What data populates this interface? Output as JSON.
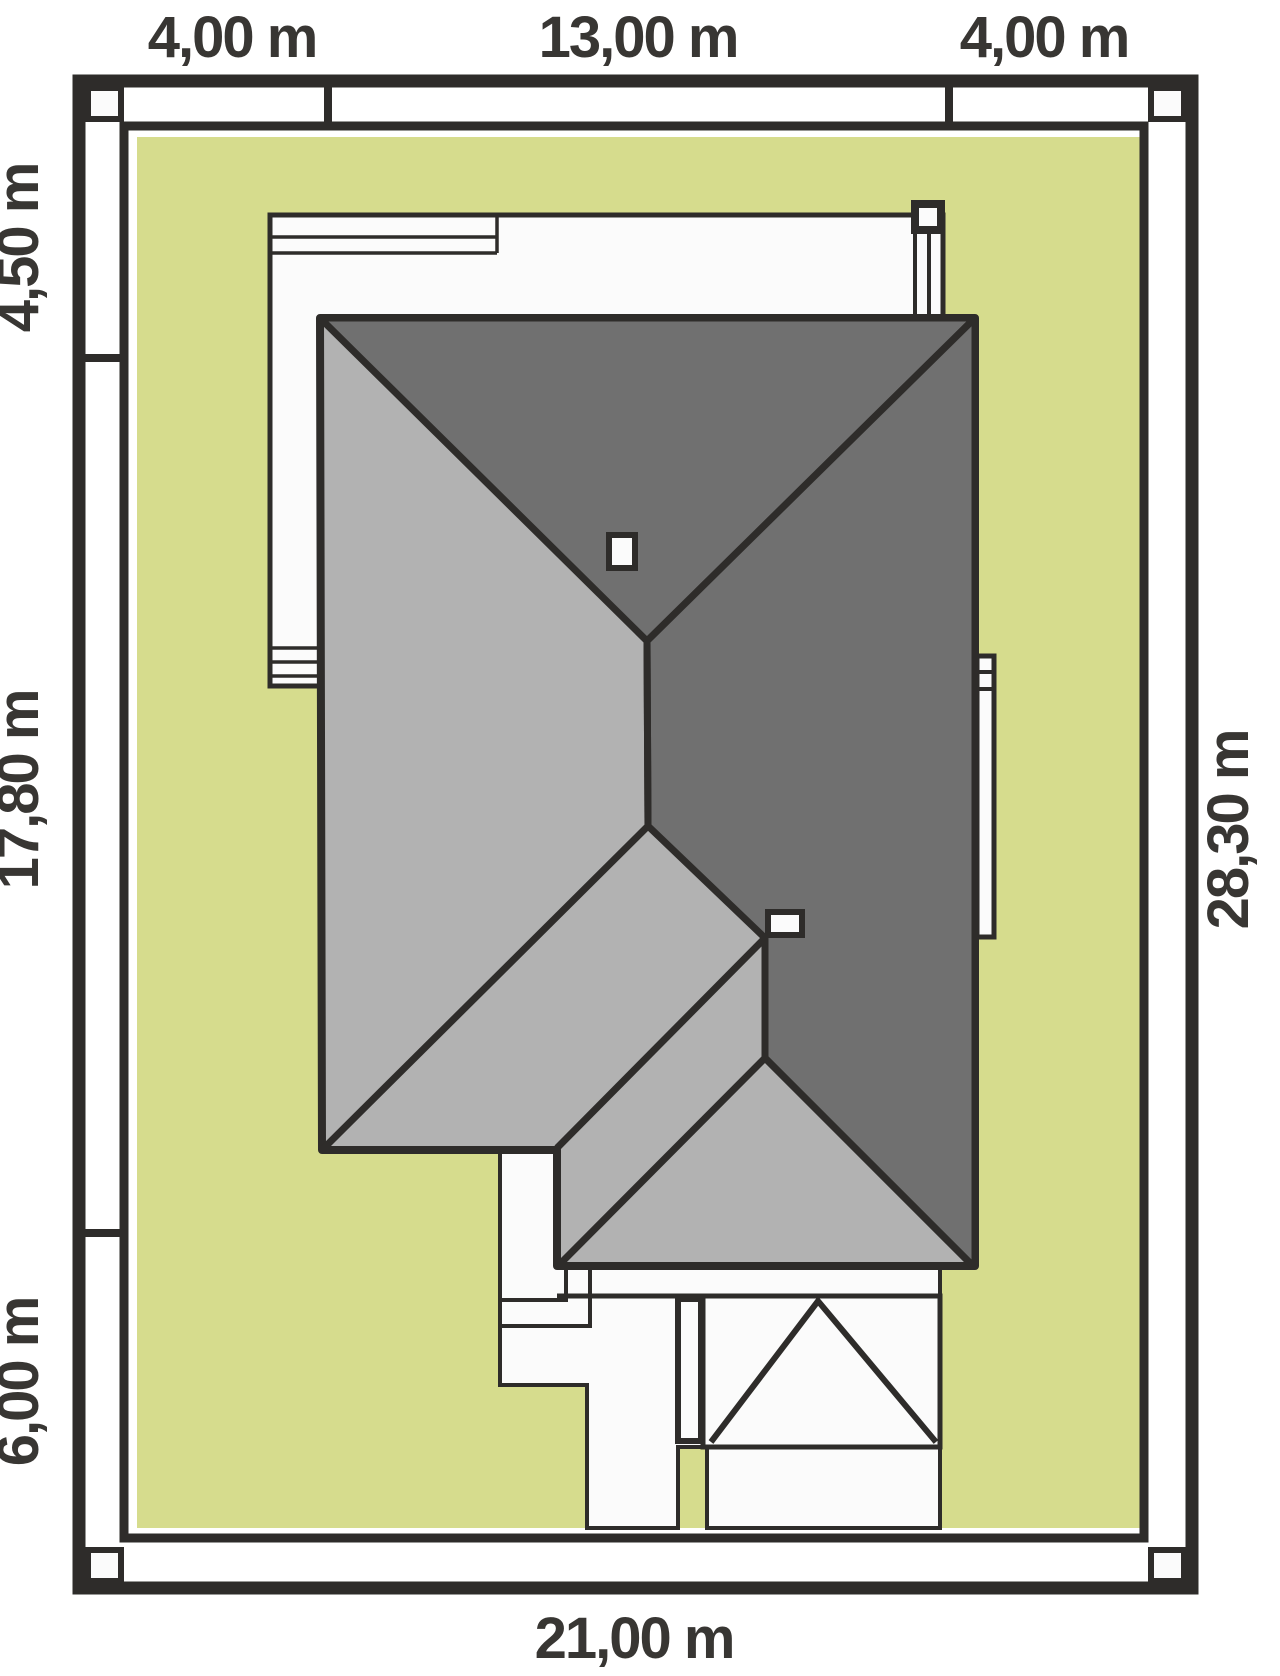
{
  "plan": {
    "type": "house-site-plan",
    "dimensions": {
      "top_left": "4,00 m",
      "top_center": "13,00 m",
      "top_right": "4,00 m",
      "left_upper": "4,50 m",
      "left_middle": "17,80 m",
      "left_lower": "6,00 m",
      "right_side": "28,30 m",
      "bottom_side": "21,00 m"
    },
    "colors": {
      "lawn": "#d6dc8d",
      "roof_dark": "#707070",
      "roof_light": "#b2b2b2",
      "outline": "#2e2c2a",
      "surface": "#fbfbfb",
      "label": "#383633"
    }
  }
}
